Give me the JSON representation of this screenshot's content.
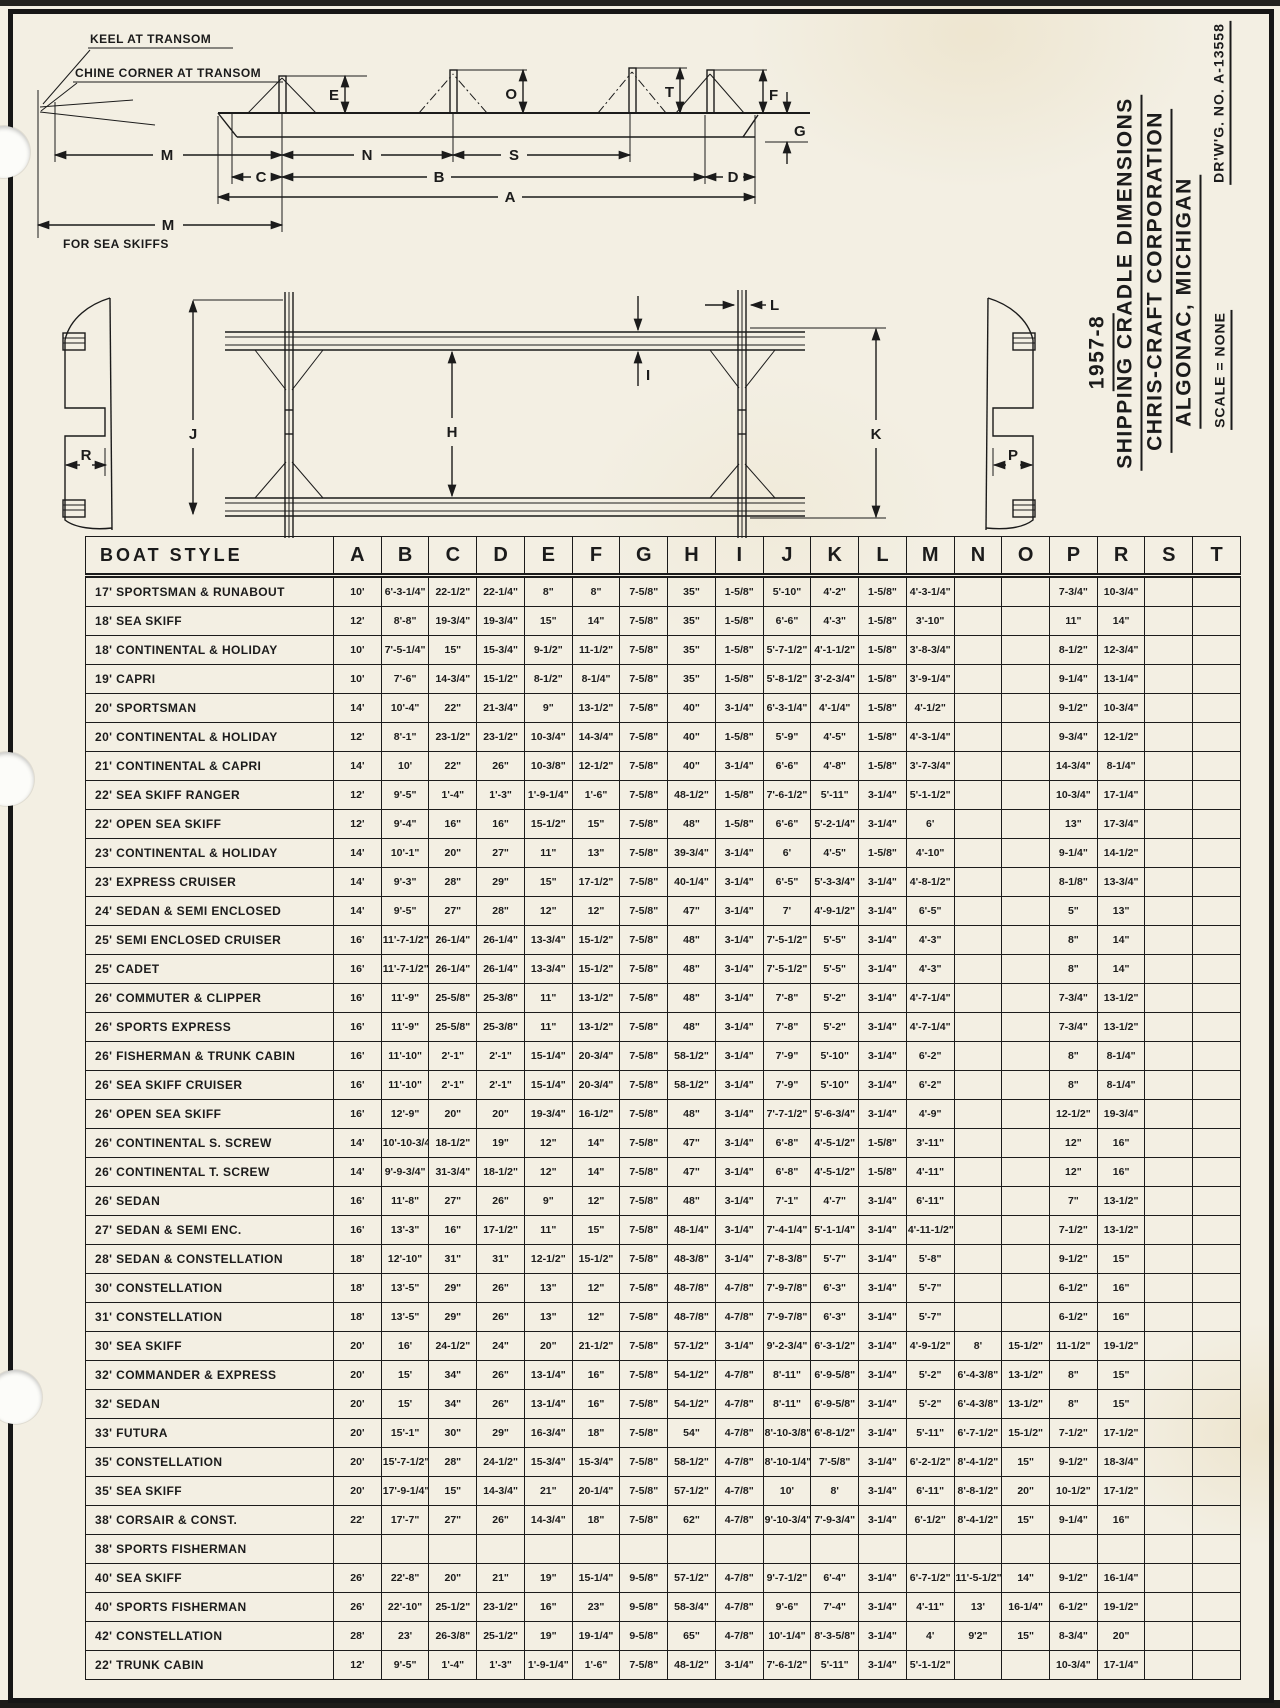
{
  "page": {
    "ink_color": "#1b1b1b",
    "paper_color": "#f3efe3"
  },
  "title_block": {
    "year": "1957-8",
    "title": "SHIPPING CRADLE DIMENSIONS",
    "company": "CHRIS-CRAFT CORPORATION",
    "location": "ALGONAC, MICHIGAN",
    "scale": "SCALE = NONE",
    "drawing_no": "DR'W'G. NO. A-13558"
  },
  "side_view": {
    "note_keel": "KEEL AT TRANSOM",
    "note_chine": "CHINE CORNER AT TRANSOM",
    "note_m": "M",
    "note_m_sub": "FOR SEA SKIFFS",
    "dims": {
      "A": "A",
      "B": "B",
      "C": "C",
      "D": "D",
      "E": "E",
      "F": "F",
      "G": "G",
      "M": "M",
      "N": "N",
      "S": "S",
      "O": "O",
      "T": "T"
    }
  },
  "plan_view": {
    "dims": {
      "H": "H",
      "I": "I",
      "J": "J",
      "K": "K",
      "L": "L",
      "P": "P",
      "R": "R"
    }
  },
  "table": {
    "header": [
      "BOAT STYLE",
      "A",
      "B",
      "C",
      "D",
      "E",
      "F",
      "G",
      "H",
      "I",
      "J",
      "K",
      "L",
      "M",
      "N",
      "O",
      "P",
      "R",
      "S",
      "T"
    ],
    "rows": [
      {
        "style": "17' SPORTSMAN & RUNABOUT",
        "dims": [
          "10'",
          "6'-3-1/4\"",
          "22-1/2\"",
          "22-1/4\"",
          "8\"",
          "8\"",
          "7-5/8\"",
          "35\"",
          "1-5/8\"",
          "5'-10\"",
          "4'-2\"",
          "1-5/8\"",
          "4'-3-1/4\"",
          "",
          "",
          "7-3/4\"",
          "10-3/4\"",
          "",
          ""
        ]
      },
      {
        "style": "18' SEA SKIFF",
        "dims": [
          "12'",
          "8'-8\"",
          "19-3/4\"",
          "19-3/4\"",
          "15\"",
          "14\"",
          "7-5/8\"",
          "35\"",
          "1-5/8\"",
          "6'-6\"",
          "4'-3\"",
          "1-5/8\"",
          "3'-10\"",
          "",
          "",
          "11\"",
          "14\"",
          "",
          ""
        ]
      },
      {
        "style": "18' CONTINENTAL & HOLIDAY",
        "dims": [
          "10'",
          "7'-5-1/4\"",
          "15\"",
          "15-3/4\"",
          "9-1/2\"",
          "11-1/2\"",
          "7-5/8\"",
          "35\"",
          "1-5/8\"",
          "5'-7-1/2\"",
          "4'-1-1/2\"",
          "1-5/8\"",
          "3'-8-3/4\"",
          "",
          "",
          "8-1/2\"",
          "12-3/4\"",
          "",
          ""
        ]
      },
      {
        "style": "19' CAPRI",
        "dims": [
          "10'",
          "7'-6\"",
          "14-3/4\"",
          "15-1/2\"",
          "8-1/2\"",
          "8-1/4\"",
          "7-5/8\"",
          "35\"",
          "1-5/8\"",
          "5'-8-1/2\"",
          "3'-2-3/4\"",
          "1-5/8\"",
          "3'-9-1/4\"",
          "",
          "",
          "9-1/4\"",
          "13-1/4\"",
          "",
          ""
        ]
      },
      {
        "style": "20' SPORTSMAN",
        "dims": [
          "14'",
          "10'-4\"",
          "22\"",
          "21-3/4\"",
          "9\"",
          "13-1/2\"",
          "7-5/8\"",
          "40\"",
          "3-1/4\"",
          "6'-3-1/4\"",
          "4'-1/4\"",
          "1-5/8\"",
          "4'-1/2\"",
          "",
          "",
          "9-1/2\"",
          "10-3/4\"",
          "",
          ""
        ]
      },
      {
        "style": "20' CONTINENTAL & HOLIDAY",
        "dims": [
          "12'",
          "8'-1\"",
          "23-1/2\"",
          "23-1/2\"",
          "10-3/4\"",
          "14-3/4\"",
          "7-5/8\"",
          "40\"",
          "1-5/8\"",
          "5'-9\"",
          "4'-5\"",
          "1-5/8\"",
          "4'-3-1/4\"",
          "",
          "",
          "9-3/4\"",
          "12-1/2\"",
          "",
          ""
        ]
      },
      {
        "style": "21' CONTINENTAL & CAPRI",
        "dims": [
          "14'",
          "10'",
          "22\"",
          "26\"",
          "10-3/8\"",
          "12-1/2\"",
          "7-5/8\"",
          "40\"",
          "3-1/4\"",
          "6'-6\"",
          "4'-8\"",
          "1-5/8\"",
          "3'-7-3/4\"",
          "",
          "",
          "14-3/4\"",
          "8-1/4\"",
          "",
          ""
        ]
      },
      {
        "style": "22' SEA SKIFF RANGER",
        "dims": [
          "12'",
          "9'-5\"",
          "1'-4\"",
          "1'-3\"",
          "1'-9-1/4\"",
          "1'-6\"",
          "7-5/8\"",
          "48-1/2\"",
          "1-5/8\"",
          "7'-6-1/2\"",
          "5'-11\"",
          "3-1/4\"",
          "5'-1-1/2\"",
          "",
          "",
          "10-3/4\"",
          "17-1/4\"",
          "",
          ""
        ]
      },
      {
        "style": "22' OPEN SEA SKIFF",
        "dims": [
          "12'",
          "9'-4\"",
          "16\"",
          "16\"",
          "15-1/2\"",
          "15\"",
          "7-5/8\"",
          "48\"",
          "1-5/8\"",
          "6'-6\"",
          "5'-2-1/4\"",
          "3-1/4\"",
          "6'",
          "",
          "",
          "13\"",
          "17-3/4\"",
          "",
          ""
        ]
      },
      {
        "style": "23' CONTINENTAL & HOLIDAY",
        "dims": [
          "14'",
          "10'-1\"",
          "20\"",
          "27\"",
          "11\"",
          "13\"",
          "7-5/8\"",
          "39-3/4\"",
          "3-1/4\"",
          "6'",
          "4'-5\"",
          "1-5/8\"",
          "4'-10\"",
          "",
          "",
          "9-1/4\"",
          "14-1/2\"",
          "",
          ""
        ]
      },
      {
        "style": "23' EXPRESS CRUISER",
        "dims": [
          "14'",
          "9'-3\"",
          "28\"",
          "29\"",
          "15\"",
          "17-1/2\"",
          "7-5/8\"",
          "40-1/4\"",
          "3-1/4\"",
          "6'-5\"",
          "5'-3-3/4\"",
          "3-1/4\"",
          "4'-8-1/2\"",
          "",
          "",
          "8-1/8\"",
          "13-3/4\"",
          "",
          ""
        ]
      },
      {
        "style": "24' SEDAN & SEMI ENCLOSED",
        "dims": [
          "14'",
          "9'-5\"",
          "27\"",
          "28\"",
          "12\"",
          "12\"",
          "7-5/8\"",
          "47\"",
          "3-1/4\"",
          "7'",
          "4'-9-1/2\"",
          "3-1/4\"",
          "6'-5\"",
          "",
          "",
          "5\"",
          "13\"",
          "",
          ""
        ]
      },
      {
        "style": "25' SEMI ENCLOSED CRUISER",
        "dims": [
          "16'",
          "11'-7-1/2\"",
          "26-1/4\"",
          "26-1/4\"",
          "13-3/4\"",
          "15-1/2\"",
          "7-5/8\"",
          "48\"",
          "3-1/4\"",
          "7'-5-1/2\"",
          "5'-5\"",
          "3-1/4\"",
          "4'-3\"",
          "",
          "",
          "8\"",
          "14\"",
          "",
          ""
        ]
      },
      {
        "style": "25' CADET",
        "dims": [
          "16'",
          "11'-7-1/2\"",
          "26-1/4\"",
          "26-1/4\"",
          "13-3/4\"",
          "15-1/2\"",
          "7-5/8\"",
          "48\"",
          "3-1/4\"",
          "7'-5-1/2\"",
          "5'-5\"",
          "3-1/4\"",
          "4'-3\"",
          "",
          "",
          "8\"",
          "14\"",
          "",
          ""
        ]
      },
      {
        "style": "26' COMMUTER & CLIPPER",
        "dims": [
          "16'",
          "11'-9\"",
          "25-5/8\"",
          "25-3/8\"",
          "11\"",
          "13-1/2\"",
          "7-5/8\"",
          "48\"",
          "3-1/4\"",
          "7'-8\"",
          "5'-2\"",
          "3-1/4\"",
          "4'-7-1/4\"",
          "",
          "",
          "7-3/4\"",
          "13-1/2\"",
          "",
          ""
        ]
      },
      {
        "style": "26' SPORTS EXPRESS",
        "dims": [
          "16'",
          "11'-9\"",
          "25-5/8\"",
          "25-3/8\"",
          "11\"",
          "13-1/2\"",
          "7-5/8\"",
          "48\"",
          "3-1/4\"",
          "7'-8\"",
          "5'-2\"",
          "3-1/4\"",
          "4'-7-1/4\"",
          "",
          "",
          "7-3/4\"",
          "13-1/2\"",
          "",
          ""
        ]
      },
      {
        "style": "26' FISHERMAN & TRUNK CABIN",
        "dims": [
          "16'",
          "11'-10\"",
          "2'-1\"",
          "2'-1\"",
          "15-1/4\"",
          "20-3/4\"",
          "7-5/8\"",
          "58-1/2\"",
          "3-1/4\"",
          "7'-9\"",
          "5'-10\"",
          "3-1/4\"",
          "6'-2\"",
          "",
          "",
          "8\"",
          "8-1/4\"",
          "",
          ""
        ]
      },
      {
        "style": "26' SEA SKIFF CRUISER",
        "dims": [
          "16'",
          "11'-10\"",
          "2'-1\"",
          "2'-1\"",
          "15-1/4\"",
          "20-3/4\"",
          "7-5/8\"",
          "58-1/2\"",
          "3-1/4\"",
          "7'-9\"",
          "5'-10\"",
          "3-1/4\"",
          "6'-2\"",
          "",
          "",
          "8\"",
          "8-1/4\"",
          "",
          ""
        ]
      },
      {
        "style": "26' OPEN SEA SKIFF",
        "dims": [
          "16'",
          "12'-9\"",
          "20\"",
          "20\"",
          "19-3/4\"",
          "16-1/2\"",
          "7-5/8\"",
          "48\"",
          "3-1/4\"",
          "7'-7-1/2\"",
          "5'-6-3/4\"",
          "3-1/4\"",
          "4'-9\"",
          "",
          "",
          "12-1/2\"",
          "19-3/4\"",
          "",
          ""
        ]
      },
      {
        "style": "26' CONTINENTAL   S. SCREW",
        "dims": [
          "14'",
          "10'-10-3/4\"",
          "18-1/2\"",
          "19\"",
          "12\"",
          "14\"",
          "7-5/8\"",
          "47\"",
          "3-1/4\"",
          "6'-8\"",
          "4'-5-1/2\"",
          "1-5/8\"",
          "3'-11\"",
          "",
          "",
          "12\"",
          "16\"",
          "",
          ""
        ]
      },
      {
        "style": "26' CONTINENTAL   T. SCREW",
        "dims": [
          "14'",
          "9'-9-3/4\"",
          "31-3/4\"",
          "18-1/2\"",
          "12\"",
          "14\"",
          "7-5/8\"",
          "47\"",
          "3-1/4\"",
          "6'-8\"",
          "4'-5-1/2\"",
          "1-5/8\"",
          "4'-11\"",
          "",
          "",
          "12\"",
          "16\"",
          "",
          ""
        ]
      },
      {
        "style": "26' SEDAN",
        "dims": [
          "16'",
          "11'-8\"",
          "27\"",
          "26\"",
          "9\"",
          "12\"",
          "7-5/8\"",
          "48\"",
          "3-1/4\"",
          "7'-1\"",
          "4'-7\"",
          "3-1/4\"",
          "6'-11\"",
          "",
          "",
          "7\"",
          "13-1/2\"",
          "",
          ""
        ]
      },
      {
        "style": "27' SEDAN & SEMI ENC.",
        "dims": [
          "16'",
          "13'-3\"",
          "16\"",
          "17-1/2\"",
          "11\"",
          "15\"",
          "7-5/8\"",
          "48-1/4\"",
          "3-1/4\"",
          "7'-4-1/4\"",
          "5'-1-1/4\"",
          "3-1/4\"",
          "4'-11-1/2\"",
          "",
          "",
          "7-1/2\"",
          "13-1/2\"",
          "",
          ""
        ]
      },
      {
        "style": "28' SEDAN & CONSTELLATION",
        "dims": [
          "18'",
          "12'-10\"",
          "31\"",
          "31\"",
          "12-1/2\"",
          "15-1/2\"",
          "7-5/8\"",
          "48-3/8\"",
          "3-1/4\"",
          "7'-8-3/8\"",
          "5'-7\"",
          "3-1/4\"",
          "5'-8\"",
          "",
          "",
          "9-1/2\"",
          "15\"",
          "",
          ""
        ]
      },
      {
        "style": "30' CONSTELLATION",
        "dims": [
          "18'",
          "13'-5\"",
          "29\"",
          "26\"",
          "13\"",
          "12\"",
          "7-5/8\"",
          "48-7/8\"",
          "4-7/8\"",
          "7'-9-7/8\"",
          "6'-3\"",
          "3-1/4\"",
          "5'-7\"",
          "",
          "",
          "6-1/2\"",
          "16\"",
          "",
          ""
        ]
      },
      {
        "style": "31' CONSTELLATION",
        "dims": [
          "18'",
          "13'-5\"",
          "29\"",
          "26\"",
          "13\"",
          "12\"",
          "7-5/8\"",
          "48-7/8\"",
          "4-7/8\"",
          "7'-9-7/8\"",
          "6'-3\"",
          "3-1/4\"",
          "5'-7\"",
          "",
          "",
          "6-1/2\"",
          "16\"",
          "",
          ""
        ]
      },
      {
        "style": "30' SEA SKIFF",
        "dims": [
          "20'",
          "16'",
          "24-1/2\"",
          "24\"",
          "20\"",
          "21-1/2\"",
          "7-5/8\"",
          "57-1/2\"",
          "3-1/4\"",
          "9'-2-3/4\"",
          "6'-3-1/2\"",
          "3-1/4\"",
          "4'-9-1/2\"",
          "8'",
          "15-1/2\"",
          "11-1/2\"",
          "19-1/2\"",
          "",
          ""
        ]
      },
      {
        "style": "32' COMMANDER & EXPRESS",
        "dims": [
          "20'",
          "15'",
          "34\"",
          "26\"",
          "13-1/4\"",
          "16\"",
          "7-5/8\"",
          "54-1/2\"",
          "4-7/8\"",
          "8'-11\"",
          "6'-9-5/8\"",
          "3-1/4\"",
          "5'-2\"",
          "6'-4-3/8\"",
          "13-1/2\"",
          "8\"",
          "15\"",
          "",
          ""
        ]
      },
      {
        "style": "32' SEDAN",
        "dims": [
          "20'",
          "15'",
          "34\"",
          "26\"",
          "13-1/4\"",
          "16\"",
          "7-5/8\"",
          "54-1/2\"",
          "4-7/8\"",
          "8'-11\"",
          "6'-9-5/8\"",
          "3-1/4\"",
          "5'-2\"",
          "6'-4-3/8\"",
          "13-1/2\"",
          "8\"",
          "15\"",
          "",
          ""
        ]
      },
      {
        "style": "33' FUTURA",
        "dims": [
          "20'",
          "15'-1\"",
          "30\"",
          "29\"",
          "16-3/4\"",
          "18\"",
          "7-5/8\"",
          "54\"",
          "4-7/8\"",
          "8'-10-3/8\"",
          "6'-8-1/2\"",
          "3-1/4\"",
          "5'-11\"",
          "6'-7-1/2\"",
          "15-1/2\"",
          "7-1/2\"",
          "17-1/2\"",
          "",
          ""
        ]
      },
      {
        "style": "35' CONSTELLATION",
        "dims": [
          "20'",
          "15'-7-1/2\"",
          "28\"",
          "24-1/2\"",
          "15-3/4\"",
          "15-3/4\"",
          "7-5/8\"",
          "58-1/2\"",
          "4-7/8\"",
          "8'-10-1/4\"",
          "7'-5/8\"",
          "3-1/4\"",
          "6'-2-1/2\"",
          "8'-4-1/2\"",
          "15\"",
          "9-1/2\"",
          "18-3/4\"",
          "",
          ""
        ]
      },
      {
        "style": "35' SEA SKIFF",
        "dims": [
          "20'",
          "17'-9-1/4\"",
          "15\"",
          "14-3/4\"",
          "21\"",
          "20-1/4\"",
          "7-5/8\"",
          "57-1/2\"",
          "4-7/8\"",
          "10'",
          "8'",
          "3-1/4\"",
          "6'-11\"",
          "8'-8-1/2\"",
          "20\"",
          "10-1/2\"",
          "17-1/2\"",
          "",
          ""
        ]
      },
      {
        "style": "38' CORSAIR & CONST.",
        "dims": [
          "22'",
          "17'-7\"",
          "27\"",
          "26\"",
          "14-3/4\"",
          "18\"",
          "7-5/8\"",
          "62\"",
          "4-7/8\"",
          "9'-10-3/4\"",
          "7'-9-3/4\"",
          "3-1/4\"",
          "6'-1/2\"",
          "8'-4-1/2\"",
          "15\"",
          "9-1/4\"",
          "16\"",
          "",
          ""
        ]
      },
      {
        "style": "38' SPORTS FISHERMAN",
        "dims": [
          "",
          "",
          "",
          "",
          "",
          "",
          "",
          "",
          "",
          "",
          "",
          "",
          "",
          "",
          "",
          "",
          "",
          "",
          ""
        ]
      },
      {
        "style": "40' SEA SKIFF",
        "dims": [
          "26'",
          "22'-8\"",
          "20\"",
          "21\"",
          "19\"",
          "15-1/4\"",
          "9-5/8\"",
          "57-1/2\"",
          "4-7/8\"",
          "9'-7-1/2\"",
          "6'-4\"",
          "3-1/4\"",
          "6'-7-1/2\"",
          "11'-5-1/2\"",
          "14\"",
          "9-1/2\"",
          "16-1/4\"",
          "",
          ""
        ]
      },
      {
        "style": "40' SPORTS FISHERMAN",
        "dims": [
          "26'",
          "22'-10\"",
          "25-1/2\"",
          "23-1/2\"",
          "16\"",
          "23\"",
          "9-5/8\"",
          "58-3/4\"",
          "4-7/8\"",
          "9'-6\"",
          "7'-4\"",
          "3-1/4\"",
          "4'-11\"",
          "13'",
          "16-1/4\"",
          "6-1/2\"",
          "19-1/2\"",
          "",
          ""
        ]
      },
      {
        "style": "42' CONSTELLATION",
        "dims": [
          "28'",
          "23'",
          "26-3/8\"",
          "25-1/2\"",
          "19\"",
          "19-1/4\"",
          "9-5/8\"",
          "65\"",
          "4-7/8\"",
          "10'-1/4\"",
          "8'-3-5/8\"",
          "3-1/4\"",
          "4'",
          "9'2\"",
          "15\"",
          "8-3/4\"",
          "20\"",
          "",
          ""
        ]
      },
      {
        "style": "22' TRUNK CABIN",
        "dims": [
          "12'",
          "9'-5\"",
          "1'-4\"",
          "1'-3\"",
          "1'-9-1/4\"",
          "1'-6\"",
          "7-5/8\"",
          "48-1/2\"",
          "3-1/4\"",
          "7'-6-1/2\"",
          "5'-11\"",
          "3-1/4\"",
          "5'-1-1/2\"",
          "",
          "",
          "10-3/4\"",
          "17-1/4\"",
          "",
          ""
        ]
      }
    ]
  }
}
